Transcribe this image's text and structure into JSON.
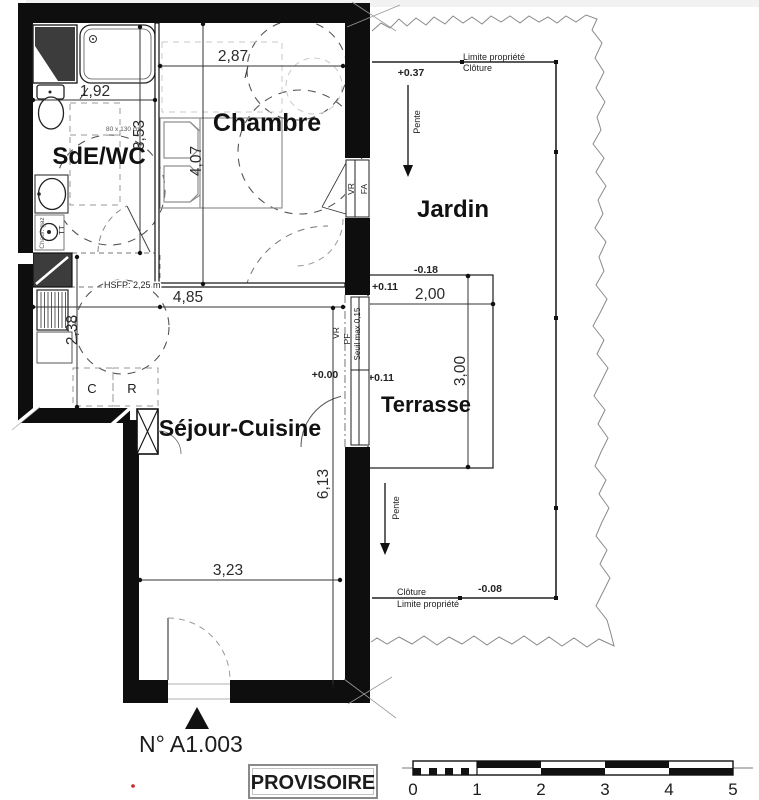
{
  "colors": {
    "wall": "#0e0e0e",
    "paper": "#ffffff",
    "dashed_guides": "#555555",
    "light_guides": "#c9c9c9",
    "torn_edge": "#8a8a8a",
    "stamp_border": "#888888",
    "red_mark": "#cc2222"
  },
  "rooms": {
    "bathroom": "SdE/WC",
    "bedroom": "Chambre",
    "living_kitchen": "Séjour-Cuisine",
    "terrace": "Terrasse",
    "garden": "Jardin"
  },
  "dimensions": {
    "bath_width": "1,92",
    "bath_length": "3,53",
    "bedroom_width": "2,87",
    "bedroom_length": "4,07",
    "living_width": "4,85",
    "kitchen_side": "2,38",
    "living_length": "6,13",
    "living_lower_width": "3,23",
    "terrace_width": "2,00",
    "terrace_length": "3,00"
  },
  "levels": {
    "garden_top": "+0.37",
    "terrace_outside": "-0.18",
    "terrace_upper": "+0.11",
    "terrace_mid": "+0.11",
    "living_floor": "+0.00",
    "garden_bottom": "-0.08"
  },
  "site": {
    "property_limit": "Limite propriété",
    "fence": "Clôture",
    "slope": "Pente"
  },
  "openings": {
    "roller_shutter": "VR",
    "tilt_window": "FA",
    "french_door": "PF",
    "threshold": "Seuil max 0,15"
  },
  "kitchen_symbols": {
    "c": "C",
    "r": "R"
  },
  "bath_annotations": {
    "gas_heater": "Chauf. gaz",
    "tt": "TT",
    "shower_clearance": "80 x 130 cm",
    "ceiling_height": "HSFP: 2,25 m"
  },
  "footer": {
    "unit_number": "N° A1.003",
    "stamp": "PROVISOIRE"
  },
  "scalebar": {
    "ticks": [
      "0",
      "1",
      "2",
      "3",
      "4",
      "5"
    ]
  }
}
